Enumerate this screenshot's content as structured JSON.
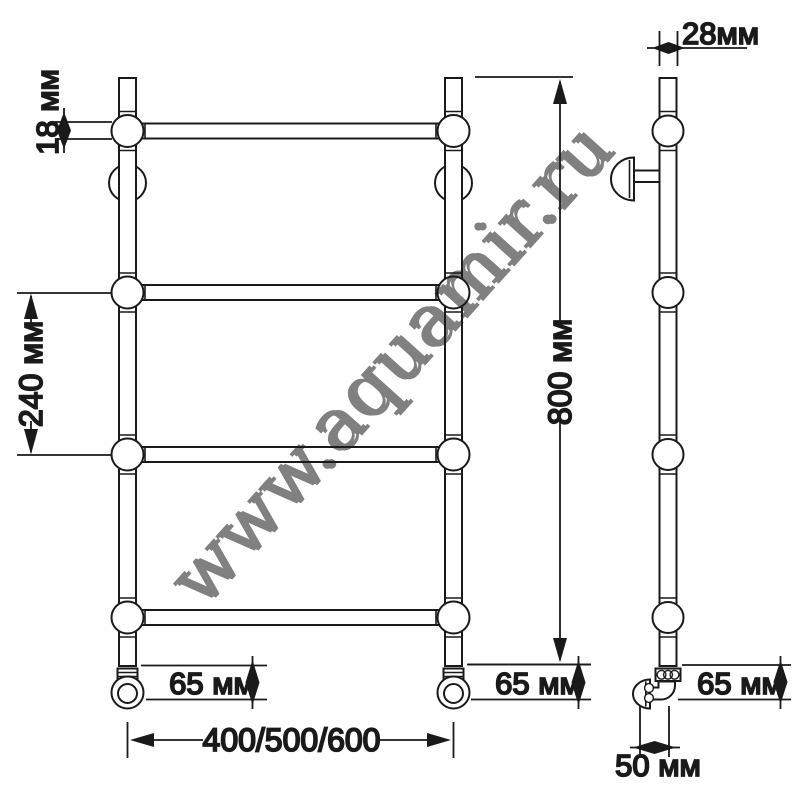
{
  "drawing": {
    "type": "technical-dimension-drawing",
    "subject": "ladder towel rail, front and side views",
    "watermark": "www.aquamir.ru",
    "colors": {
      "line": "#1a1a1a",
      "background": "#ffffff",
      "watermark_gray": "#ccd1d5"
    },
    "front_view": {
      "rungs": 4,
      "wall_brackets": 2,
      "feet": 2
    },
    "side_view": {
      "balls": 4,
      "wall_brackets": 1,
      "feet": 1
    },
    "dimensions": {
      "tube_diameter": "18 мм",
      "rung_spacing": "240 мм",
      "overall_height": "800 мм",
      "side_tube_width": "28мм",
      "foot_height_front_left": "65 мм",
      "foot_height_front_right": "65 мм",
      "foot_height_side": "65 мм",
      "width_options": "400/500/600",
      "wall_offset": "50 мм"
    }
  }
}
